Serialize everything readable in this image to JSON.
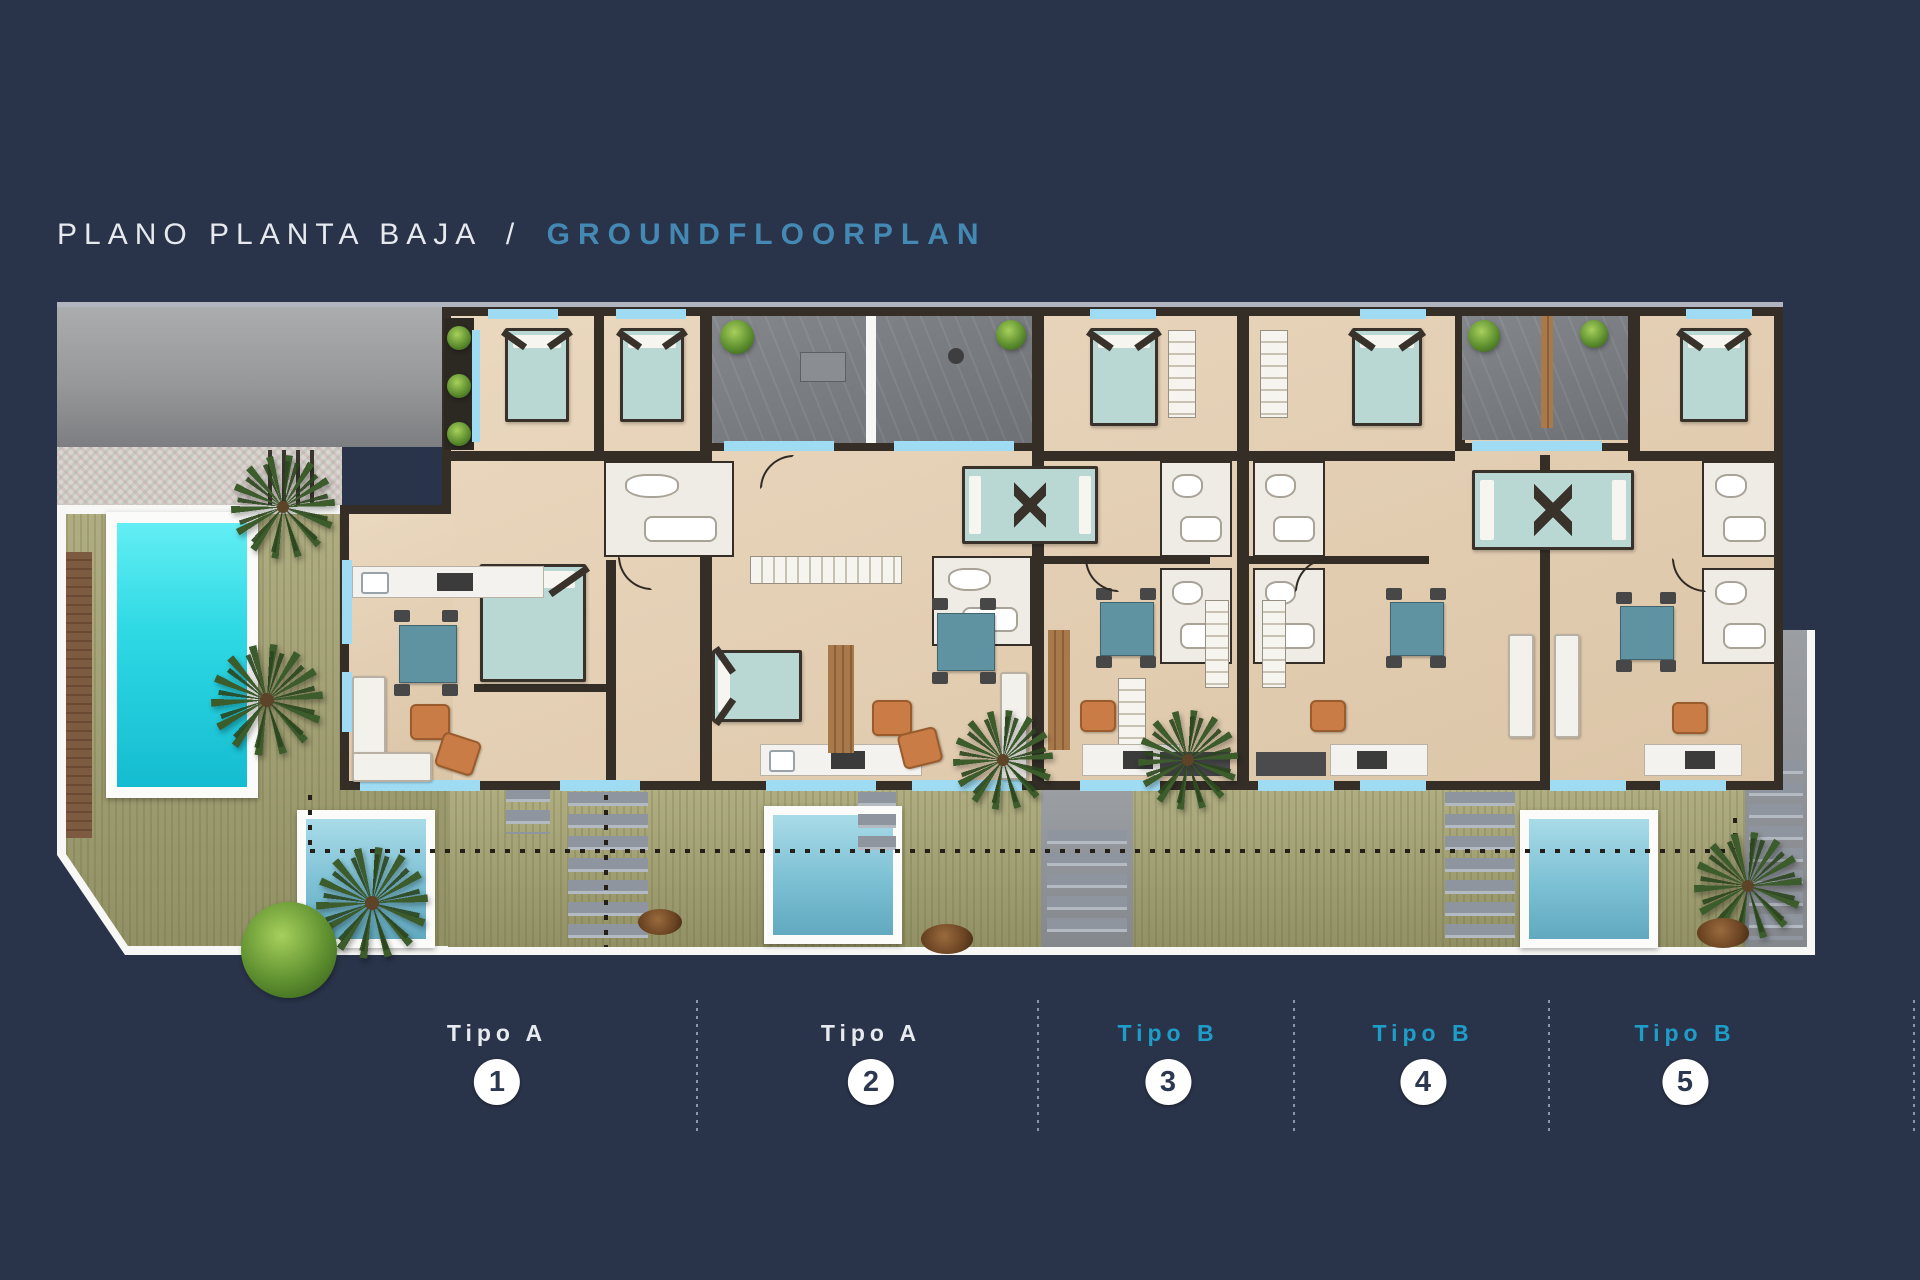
{
  "title": {
    "primary": "PLANO PLANTA BAJA",
    "separator": "/",
    "secondary": "GROUNDFLOORPLAN"
  },
  "units": [
    {
      "type_label": "Tipo A",
      "number": "1",
      "accent": "white"
    },
    {
      "type_label": "Tipo A",
      "number": "2",
      "accent": "white"
    },
    {
      "type_label": "Tipo B",
      "number": "3",
      "accent": "blue"
    },
    {
      "type_label": "Tipo B",
      "number": "4",
      "accent": "blue"
    },
    {
      "type_label": "Tipo B",
      "number": "5",
      "accent": "blue"
    }
  ],
  "palette": {
    "bg": "#293349",
    "title_text": "#e6e9ed",
    "title_accent": "#4489b4",
    "tipo_b_accent": "#1f9dc9",
    "badge_bg": "#ffffff",
    "badge_text": "#2c3850",
    "wall": "#342e27",
    "glass": "#9fdcf4",
    "lawn": "#a6a473",
    "pool": "#2fd9e4",
    "plunge": "#7cc0d4",
    "patio": "#75777b",
    "mattress": "#b9d8d3",
    "table": "#5f93a2",
    "chair": "#c97c45",
    "sofa": "#f3f1ec",
    "palm": "#3c5c2c",
    "wood": "#7b5a40"
  }
}
